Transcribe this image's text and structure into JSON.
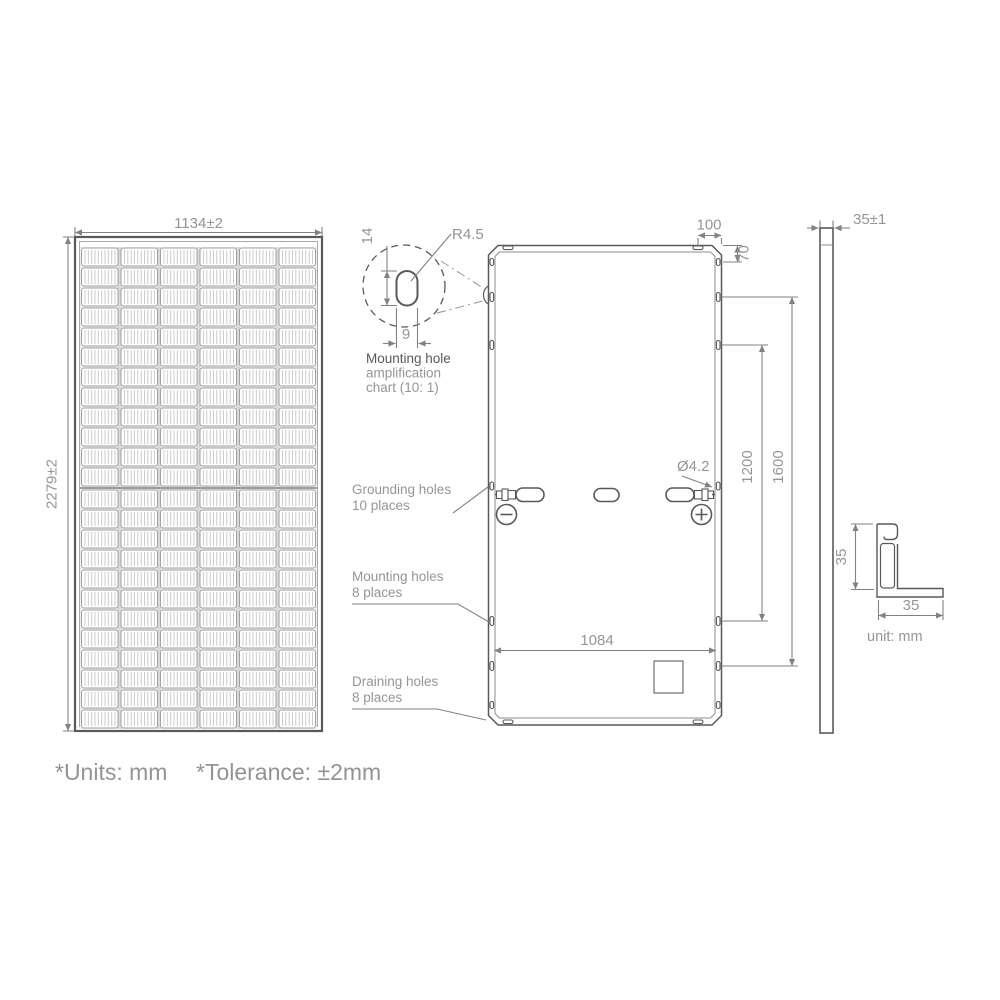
{
  "page": {
    "footnote_units": "*Units: mm",
    "footnote_tolerance": "*Tolerance: ±2mm"
  },
  "front_view": {
    "width_dim": "1134±2",
    "height_dim": "2279±2"
  },
  "mounting_hole_detail": {
    "radius_label": "R4.5",
    "slot_height_label": "14",
    "slot_width_label": "9",
    "caption_line1": "Mounting hole",
    "caption_line2": "amplification",
    "caption_line3": "chart (10: 1)"
  },
  "back_view": {
    "dim_corner_hole_offset": "100",
    "dim_top_hole_offset": "70",
    "dim_mounting_span_inner": "1200",
    "dim_mounting_span_outer": "1600",
    "dim_bottom_inner_width": "1084",
    "grounding_hole_diameter": "Ø4.2",
    "label_grounding_line1": "Grounding holes",
    "label_grounding_line2": "10 places",
    "label_mounting_line1": "Mounting holes",
    "label_mounting_line2": "8 places",
    "label_draining_line1": "Draining holes",
    "label_draining_line2": "8 places"
  },
  "side_view": {
    "thickness_dim": "35±1"
  },
  "frame_section": {
    "height_dim": "35",
    "width_dim": "35",
    "unit_label": "unit: mm"
  },
  "colors": {
    "outline": "#58595b",
    "dimension": "#808285",
    "text_gray": "#939598"
  }
}
